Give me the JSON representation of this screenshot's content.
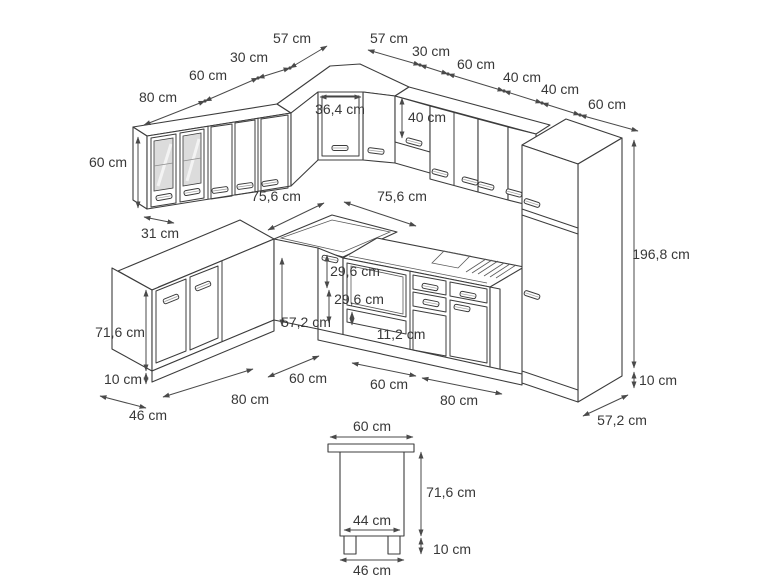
{
  "meta": {
    "units": "cm",
    "background_color": "#ffffff",
    "line_color": "#3c3c3c",
    "dimension_color": "#4a4a4a",
    "text_color": "#383838",
    "drawing_type": "kitchen corner unit dimension drawing (isometric view + base cabinet side view)"
  },
  "dimensions": {
    "wall_left": {
      "w80": "80 cm",
      "w60": "60 cm",
      "w30": "30 cm",
      "w57": "57 cm",
      "height": "60 cm",
      "depth": "31 cm"
    },
    "corner": {
      "door_width": "36,4 cm"
    },
    "wall_right": {
      "w57": "57 cm",
      "w30": "30 cm",
      "w60": "60 cm",
      "w40a": "40 cm",
      "w40b": "40 cm",
      "w60_tall": "60 cm",
      "hood_height": "40 cm"
    },
    "clearance": {
      "left": "75,6 cm",
      "right": "75,6 cm"
    },
    "base": {
      "corner_drawer_a": "29,6 cm",
      "corner_drawer_b": "29,6 cm",
      "front_height": "57,2 cm",
      "oven_drawer": "11,2 cm",
      "height": "71,6 cm",
      "plinth_left": "10 cm",
      "depth_left": "46 cm",
      "w80_left": "80 cm",
      "w60_left": "60 cm",
      "w60_right": "60 cm",
      "w80_right": "80 cm",
      "plinth_right": "10 cm",
      "depth_right": "57,2 cm"
    },
    "tall": {
      "height": "196,8 cm"
    },
    "side_view": {
      "counter_depth": "60 cm",
      "body_height": "71,6 cm",
      "inner_width": "44 cm",
      "plinth_height": "10 cm",
      "base_depth": "46 cm"
    }
  }
}
